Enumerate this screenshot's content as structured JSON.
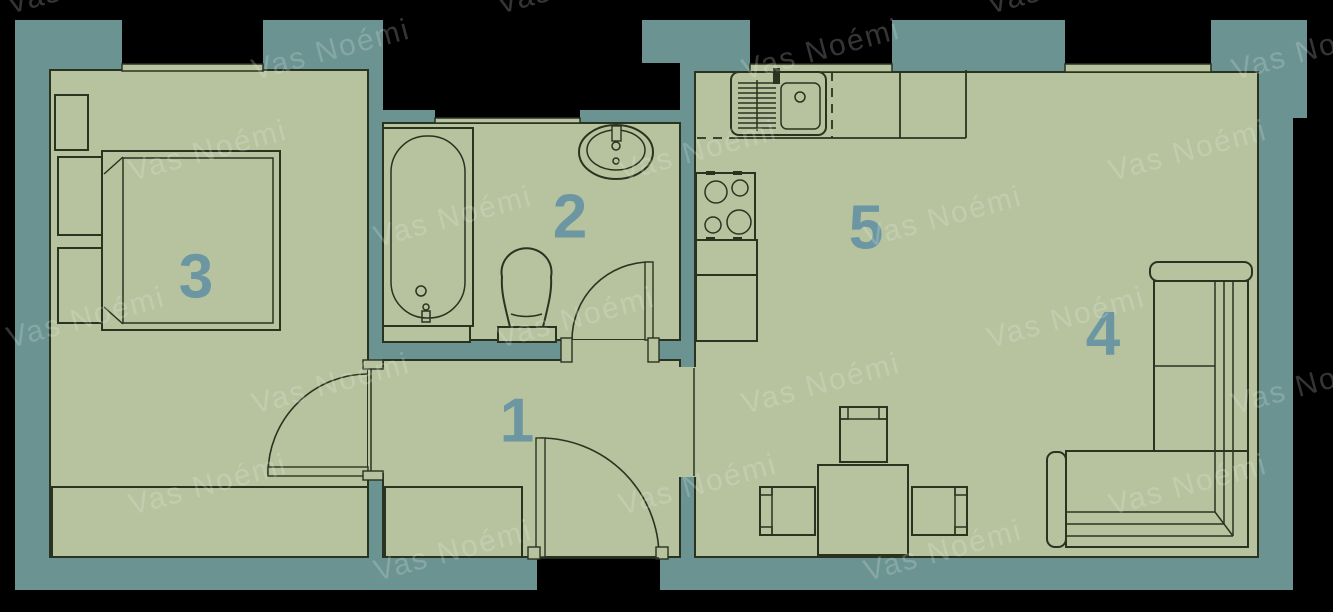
{
  "watermark": {
    "text": "Vas Noémi"
  },
  "rooms": [
    {
      "number": "1"
    },
    {
      "number": "2"
    },
    {
      "number": "3"
    },
    {
      "number": "4"
    },
    {
      "number": "5"
    }
  ],
  "colors": {
    "background": "#000000",
    "wall": "#6a9391",
    "floor": "#b6c39e",
    "line": "#2a3320",
    "room_number": "#6b96a2",
    "watermark": "rgba(238,242,238,0.22)"
  }
}
